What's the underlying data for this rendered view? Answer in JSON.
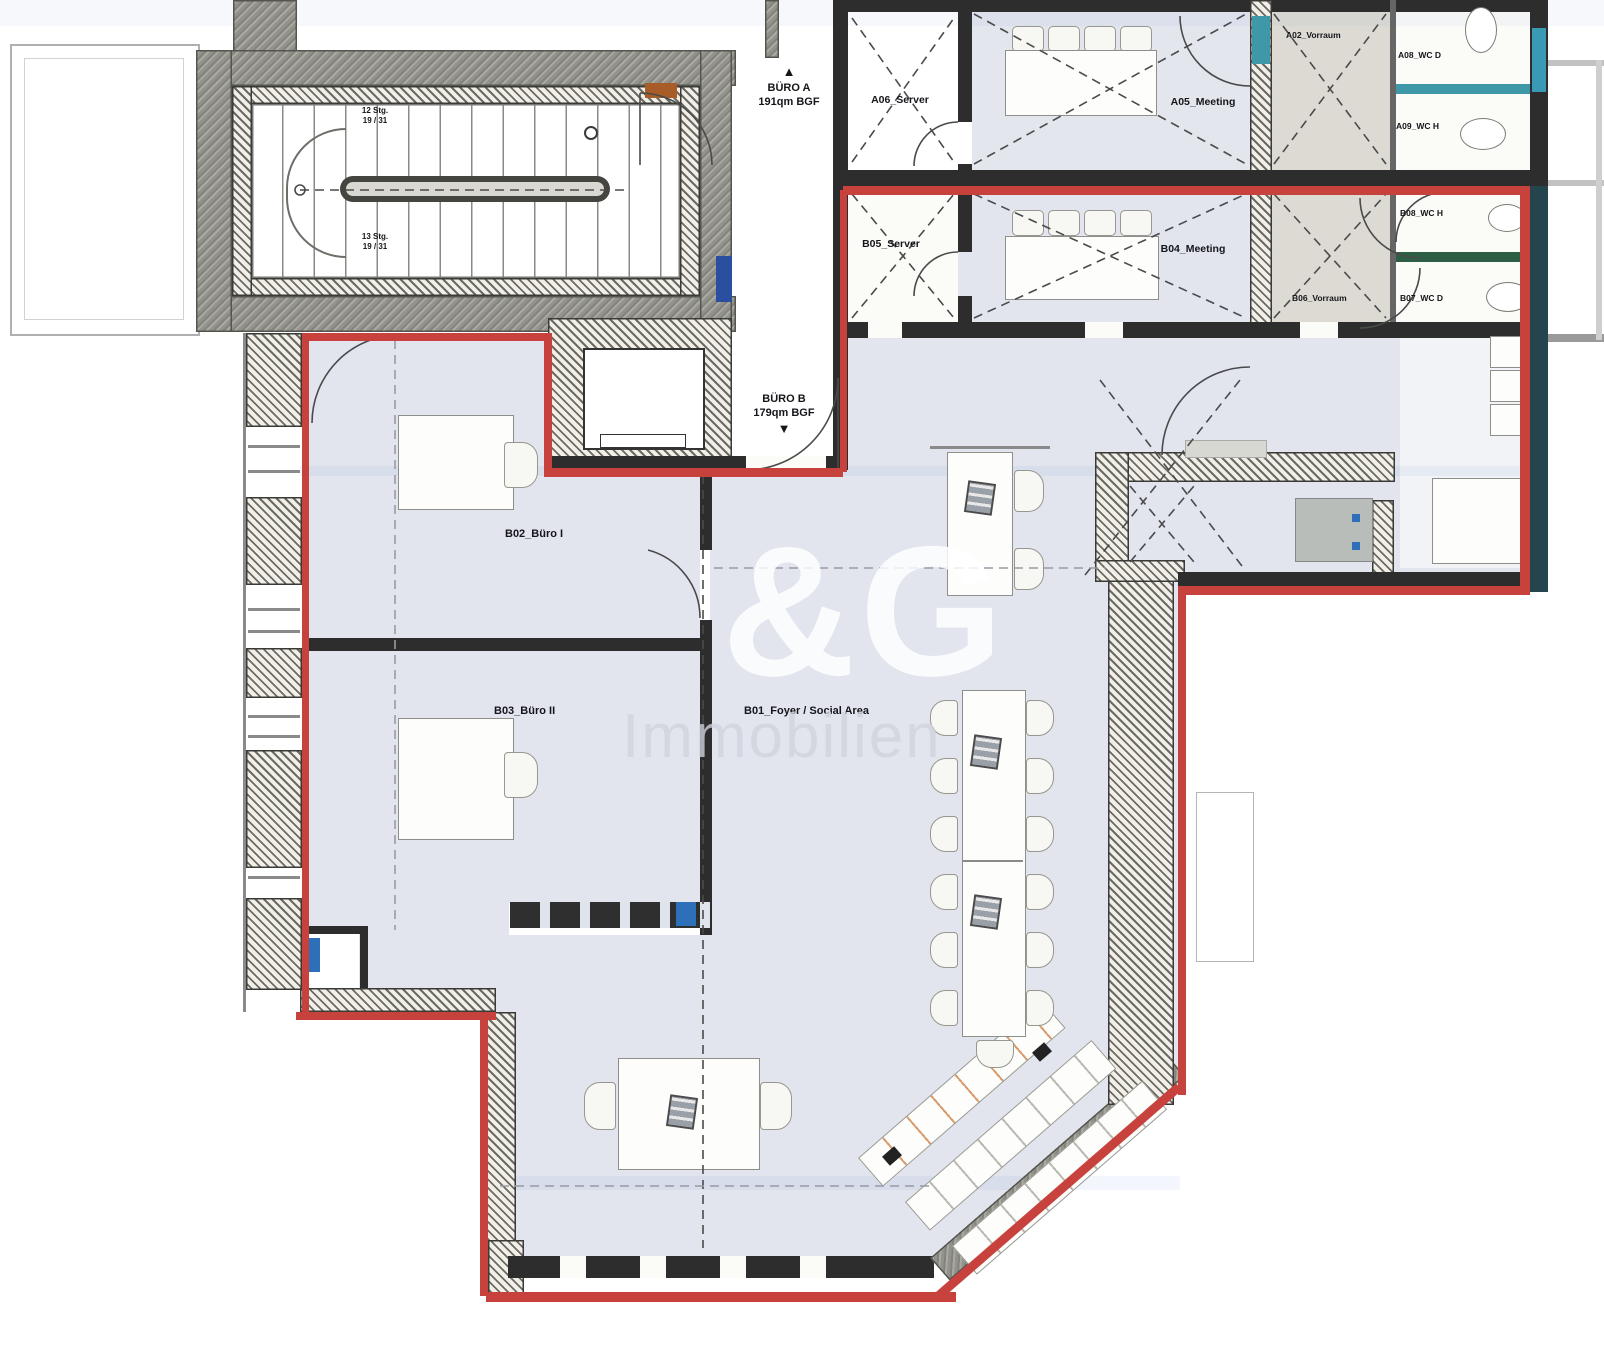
{
  "plan": {
    "units": {
      "buero_a": {
        "name": "BÜRO A",
        "area": "191qm BGF"
      },
      "buero_b": {
        "name": "BÜRO B",
        "area": "179qm BGF"
      }
    },
    "rooms": {
      "a06_server": "A06_Server",
      "b05_server": "B05_Server",
      "a05_meeting": "A05_Meeting",
      "b04_meeting": "B04_Meeting",
      "a02_vorraum": "A02_Vorraum",
      "a08_wc_d": "A08_WC D",
      "a09_wc_h": "A09_WC H",
      "b08_wc_h": "B08_WC H",
      "b07_wc_d": "B07_WC D",
      "b06_vorraum": "B06_Vorraum",
      "b02_buero_i": "B02_Büro I",
      "b03_buero_ii": "B03_Büro II",
      "b01_foyer": "B01_Foyer / Social Area"
    },
    "stairs": {
      "upper": {
        "line1": "12 Stg.",
        "line2": "19 / 31"
      },
      "lower": {
        "line1": "13 Stg.",
        "line2": "19 / 31"
      }
    },
    "icons": {
      "up_arrow": "▲",
      "down_arrow": "▼"
    },
    "watermark": {
      "line1": "&G",
      "line2": "Immobilien"
    },
    "colors": {
      "boundary_red": "#c8423d",
      "wall": "#2d2d2d",
      "floor_tint": "#e2e5ee",
      "teal": "#3e98a8"
    }
  }
}
